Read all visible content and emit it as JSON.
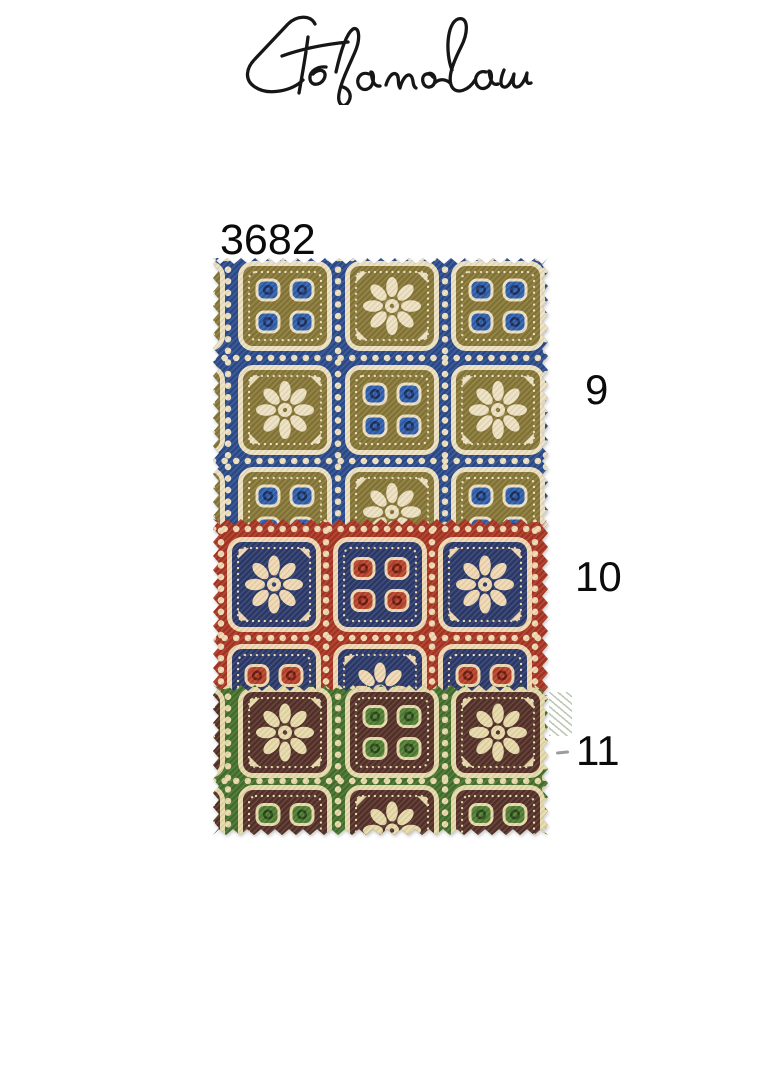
{
  "page": {
    "background_color": "#ffffff"
  },
  "header": {
    "signature_text": "Stefano Cau"
  },
  "pattern_number": "3682",
  "swatches": [
    {
      "label": "9",
      "colors": {
        "background": "#2b4b8b",
        "square": "#877737",
        "motif": "#eee1c2",
        "accent": "#2e5fae",
        "mark": "#1d2f5a"
      },
      "size": {
        "width": 335,
        "height": 272
      },
      "edges": {
        "top": true,
        "right": true,
        "bottom": false,
        "left": true
      },
      "grid": {
        "square_w": 84,
        "square_h": 80,
        "col_x": [
          -77,
          30,
          137,
          243
        ],
        "row_y": [
          8,
          112,
          214
        ],
        "vline_x": [
          15,
          125,
          232,
          333
        ],
        "hline_y": [
          0,
          100,
          203
        ],
        "motifs": [
          [
            "flower",
            "dots",
            "flower",
            "dots"
          ],
          [
            "dots",
            "flower",
            "dots",
            "flower"
          ],
          [
            "flower",
            "dots",
            "flower",
            "dots"
          ]
        ]
      }
    },
    {
      "label": "10",
      "colors": {
        "background": "#a93523",
        "square": "#2c3a6a",
        "motif": "#f0d8b2",
        "accent": "#b8432b",
        "mark": "#6e1c10"
      },
      "size": {
        "width": 335,
        "height": 177
      },
      "edges": {
        "top": true,
        "right": true,
        "bottom": false,
        "left": true
      },
      "grid": {
        "square_w": 84,
        "square_h": 85,
        "col_x": [
          19,
          125,
          230
        ],
        "row_y": [
          23,
          130
        ],
        "vline_x": [
          8,
          113,
          219,
          322
        ],
        "hline_y": [
          10,
          119
        ],
        "motifs": [
          [
            "flower",
            "dots",
            "flower"
          ],
          [
            "dots",
            "flower",
            "dots"
          ]
        ]
      }
    },
    {
      "label": "11",
      "colors": {
        "background": "#45702d",
        "square": "#553129",
        "motif": "#e7daaa",
        "accent": "#507e33",
        "mark": "#2b461b"
      },
      "size": {
        "width": 335,
        "height": 150
      },
      "edges": {
        "top": true,
        "right": true,
        "bottom": true,
        "left": true
      },
      "grid": {
        "square_w": 84,
        "square_h": 81,
        "col_x": [
          -77,
          30,
          137,
          243
        ],
        "row_y": [
          7,
          105
        ],
        "vline_x": [
          15,
          125,
          232,
          332
        ],
        "hline_y": [
          1,
          96
        ],
        "motifs": [
          [
            "dots",
            "flower",
            "dots",
            "flower"
          ],
          [
            "flower",
            "dots",
            "flower",
            "dots"
          ]
        ]
      }
    }
  ]
}
